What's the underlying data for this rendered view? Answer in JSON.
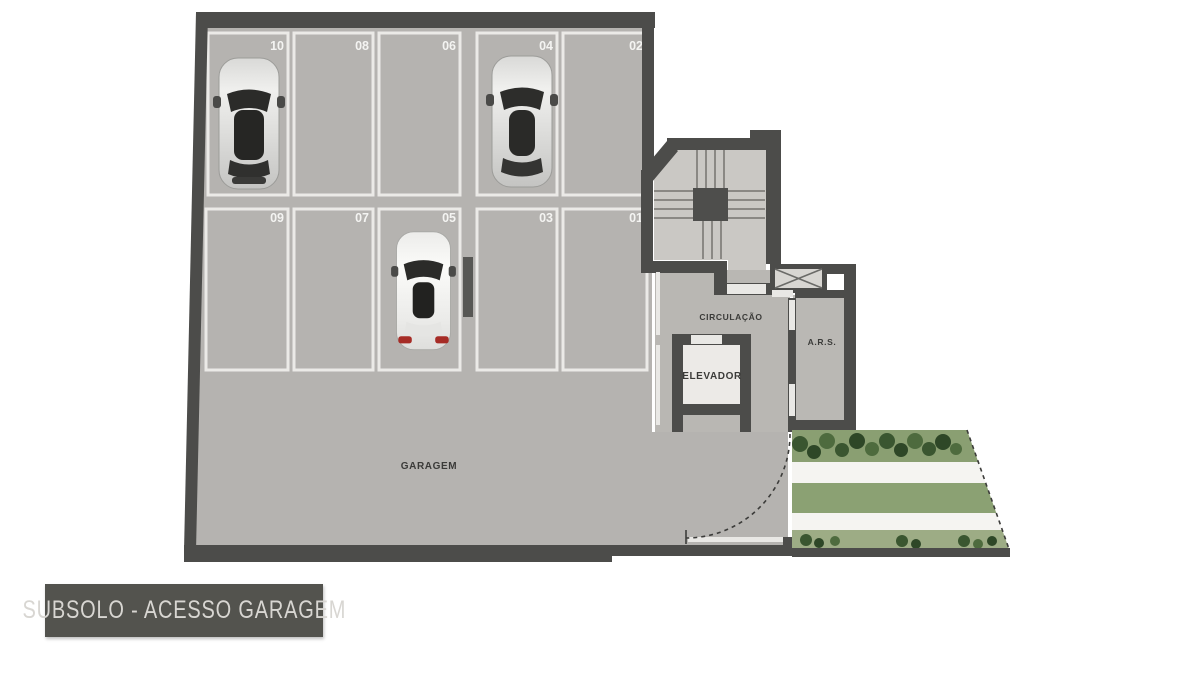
{
  "title": {
    "label": "SUBSOLO - ACESSO GARAGEM"
  },
  "rooms": {
    "garage": "GARAGEM",
    "circulation": "CIRCULAÇÃO",
    "elevator": "ELEVADOR",
    "ars": "A.R.S."
  },
  "parking": {
    "rows": 2,
    "spaces": [
      {
        "number": "10",
        "row": "top",
        "occupied": true
      },
      {
        "number": "08",
        "row": "top",
        "occupied": false
      },
      {
        "number": "06",
        "row": "top",
        "occupied": false
      },
      {
        "number": "04",
        "row": "top",
        "occupied": true
      },
      {
        "number": "02",
        "row": "top",
        "occupied": false
      },
      {
        "number": "09",
        "row": "bottom",
        "occupied": false
      },
      {
        "number": "07",
        "row": "bottom",
        "occupied": false
      },
      {
        "number": "05",
        "row": "bottom",
        "occupied": true
      },
      {
        "number": "03",
        "row": "bottom",
        "occupied": false
      },
      {
        "number": "01",
        "row": "bottom",
        "occupied": false
      }
    ]
  },
  "cars": [
    {
      "space": "10",
      "color": "silver"
    },
    {
      "space": "04",
      "color": "silver"
    },
    {
      "space": "05",
      "color": "white"
    }
  ],
  "colors": {
    "wall": "#4c4c4a",
    "garage_floor": "#b5b3b0",
    "stair_floor": "#cac8c4",
    "circulation_floor": "#b9b7b3",
    "elevator_floor": "#eceae7",
    "parking_line": "#ebeae7",
    "pillar": "#575754",
    "grass": "#8ba173",
    "shrub": "#3a5630",
    "walkway": "#f5f4f1",
    "title_bg": "#53534e",
    "title_text": "#d8d6d2",
    "space_number_text": "#f4f4f2"
  }
}
